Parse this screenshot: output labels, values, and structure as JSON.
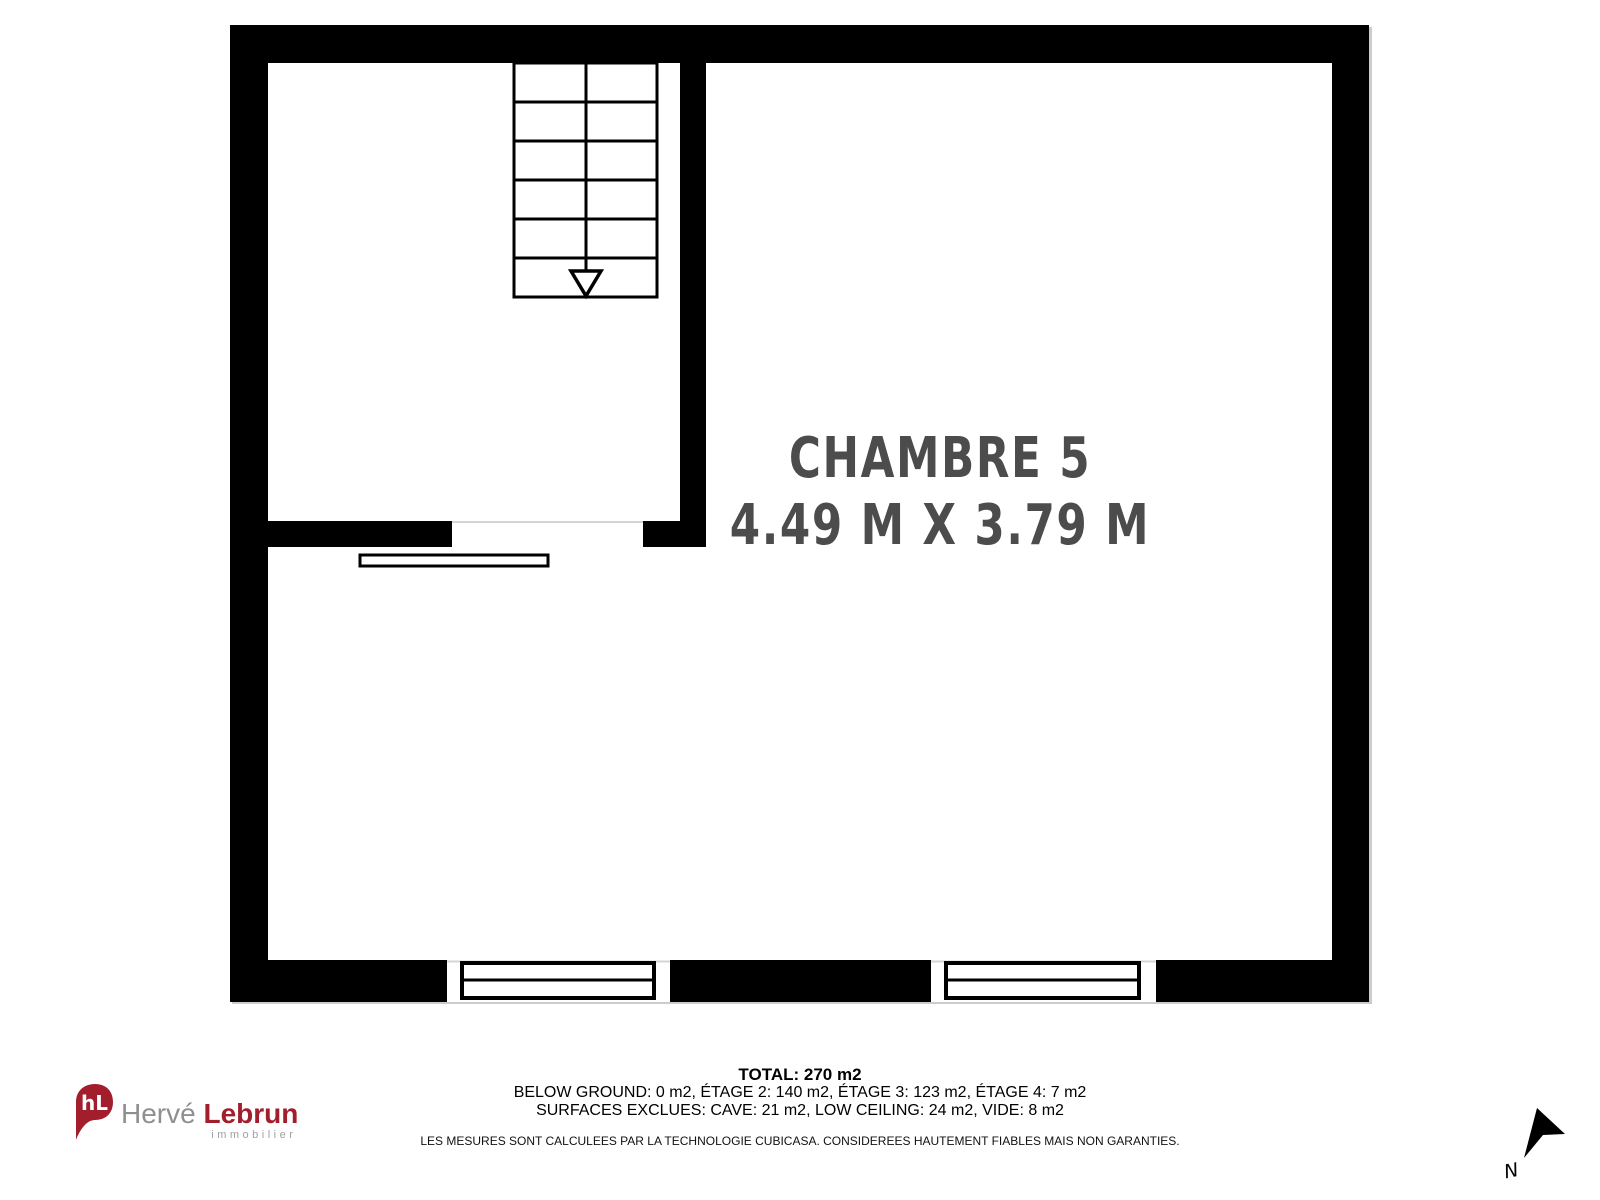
{
  "plan": {
    "room": {
      "label": "CHAMBRE 5",
      "dimensions": "4.49 M X 3.79 M"
    }
  },
  "summary": {
    "total": "TOTAL: 270 m2",
    "floor_areas": "BELOW GROUND: 0 m2, ÉTAGE 2: 140 m2, ÉTAGE 3: 123 m2, ÉTAGE 4: 7 m2",
    "excluded_areas": "SURFACES EXCLUES: CAVE: 21 m2, LOW CEILING: 24 m2, VIDE: 8 m2",
    "disclaimer": "LES MESURES SONT CALCULEES PAR LA TECHNOLOGIE CUBICASA. CONSIDEREES HAUTEMENT FIABLES MAIS NON GARANTIES."
  },
  "logo": {
    "monogram": "hL",
    "first_name": "Hervé",
    "last_name": "Lebrun",
    "tagline": "immobilier"
  },
  "compass": {
    "north_label": "N"
  },
  "colors": {
    "wall": "#000000",
    "room_text": "#4c4c4c",
    "brand_red": "#a31e2d",
    "logo_gray": "#8f8f8f",
    "opening_line": "#d4d4d4"
  }
}
